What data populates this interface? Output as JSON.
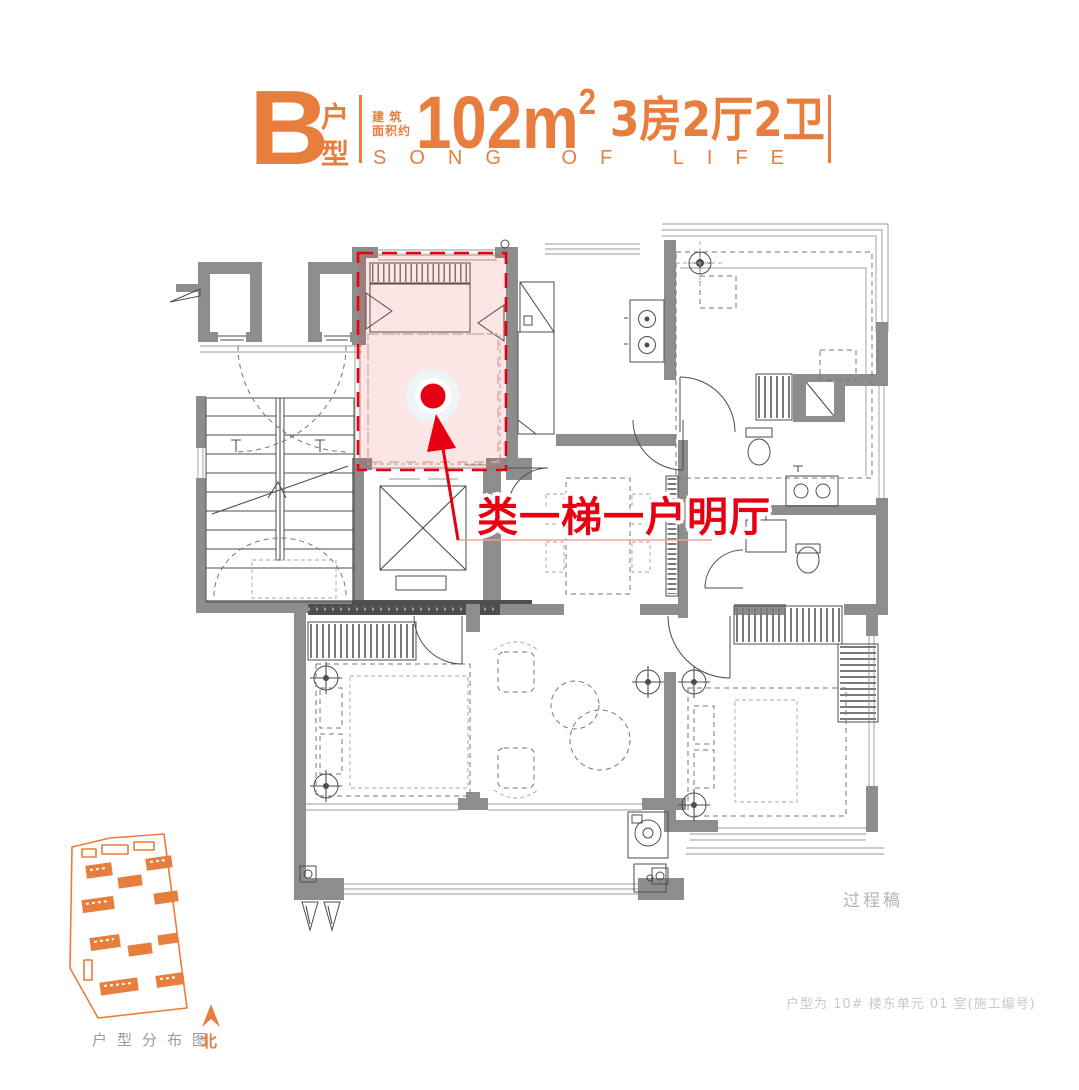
{
  "header": {
    "unit_letter": "B",
    "unit_label": "户型",
    "area_prefix_top": "建 筑",
    "area_prefix_bottom": "面积约",
    "area_value": "102m",
    "area_superscript": "2",
    "room_config": "3房2厅2卫",
    "slogan": "SONG OF LIFE"
  },
  "plan": {
    "highlight_label": "类一梯一户明厅",
    "watermark": "过程稿"
  },
  "sitemap": {
    "caption": "户型分布图",
    "north_label": "北"
  },
  "footer": {
    "unit_note": "户型为 10# 楼东单元 01 室(施工编号)"
  },
  "colors": {
    "accent_orange": "#e87e3d",
    "marker_red": "#e60012",
    "wall_gray": "#8d8d8d",
    "highlight_pink": "rgba(230,50,40,0.12)",
    "note_gray": "#c9c9c9"
  }
}
